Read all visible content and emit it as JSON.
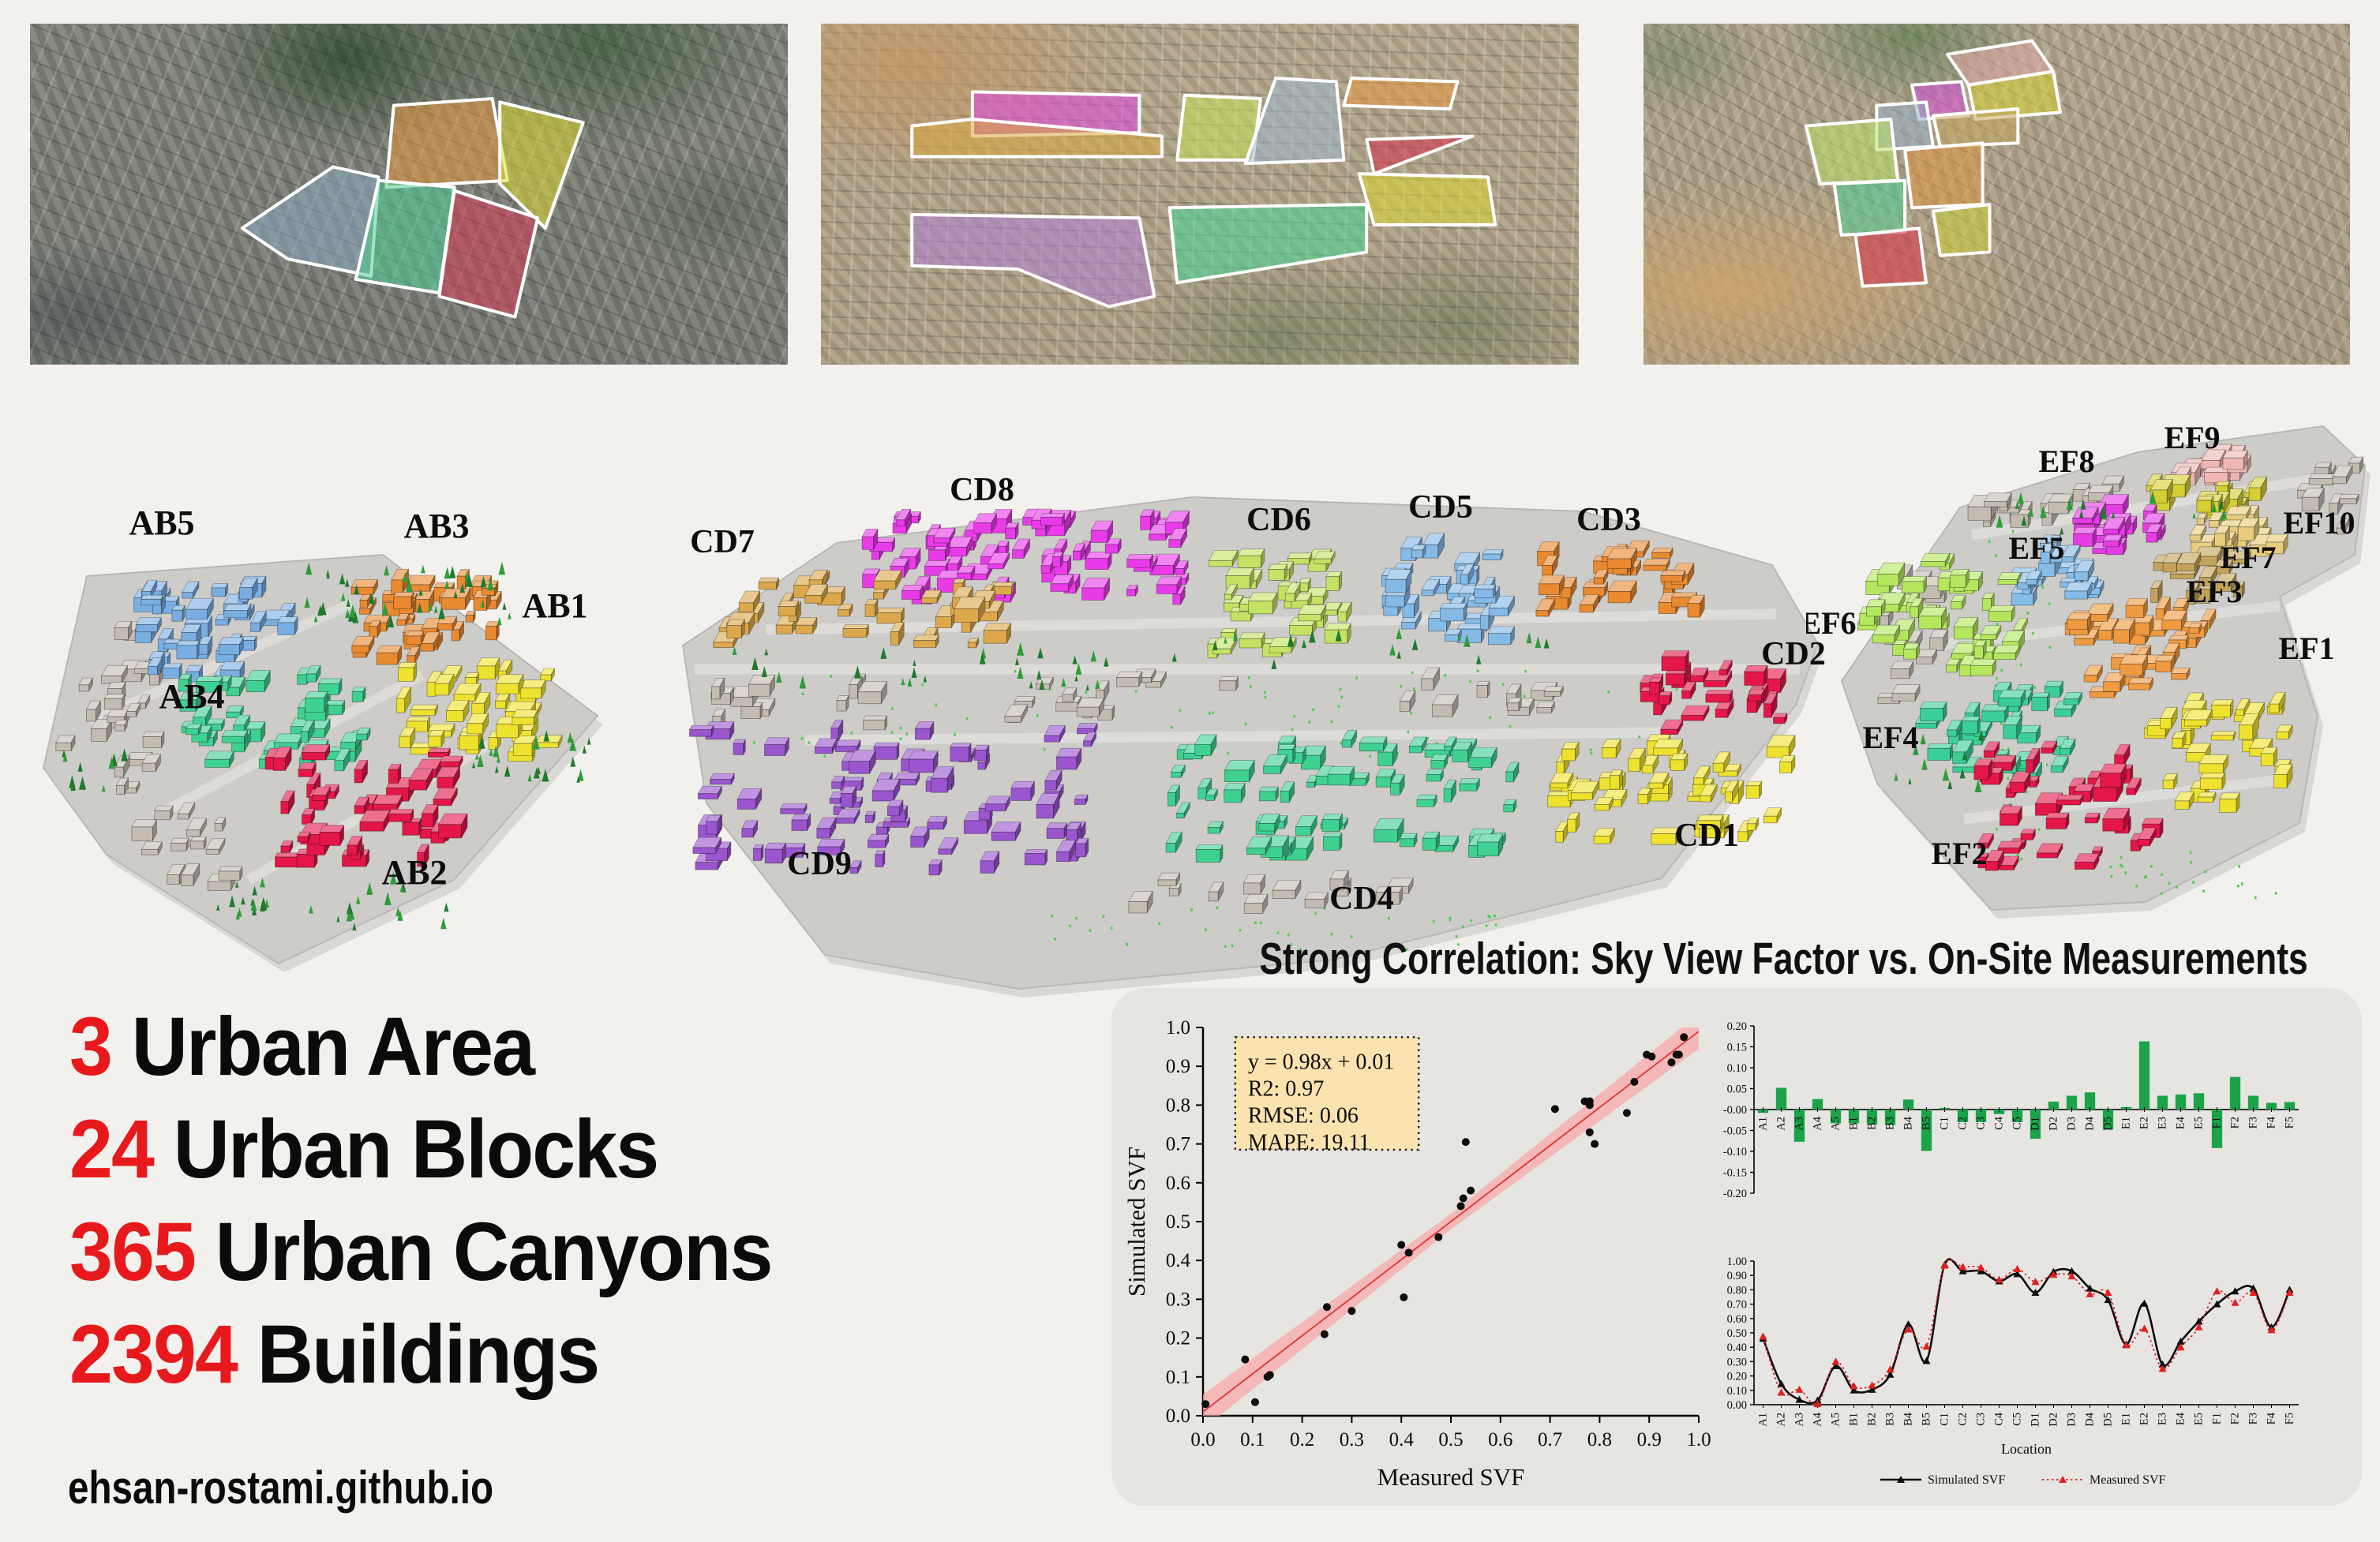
{
  "page": {
    "background": "#f2f1ee",
    "panel_background": "#e6e5e2",
    "accent_red": "#e8191c",
    "footer": "ehsan-rostami.github.io"
  },
  "stats": [
    {
      "value": "3",
      "label": "Urban Area"
    },
    {
      "value": "24",
      "label": "Urban Blocks"
    },
    {
      "value": "365",
      "label": "Urban Canyons"
    },
    {
      "value": "2394",
      "label": "Buildings"
    }
  ],
  "satellite_maps": [
    {
      "name": "urban-area-1",
      "blocks": [
        {
          "id": "o",
          "color": "#e8973f"
        },
        {
          "id": "y",
          "color": "#ded832"
        },
        {
          "id": "b",
          "color": "#8aa7c0"
        },
        {
          "id": "g",
          "color": "#4fd096"
        },
        {
          "id": "r",
          "color": "#d63a55"
        }
      ]
    },
    {
      "name": "urban-area-2",
      "blocks": [
        {
          "id": "m",
          "color": "#e147e1"
        },
        {
          "id": "gd",
          "color": "#d8a93f"
        },
        {
          "id": "yg",
          "color": "#c6e35a"
        },
        {
          "id": "bl",
          "color": "#9db8cf"
        },
        {
          "id": "or",
          "color": "#e8973f"
        },
        {
          "id": "re",
          "color": "#d62f4a"
        },
        {
          "id": "ye",
          "color": "#ded832"
        },
        {
          "id": "gr",
          "color": "#45d795"
        },
        {
          "id": "pu",
          "color": "#b07fd6"
        }
      ]
    },
    {
      "name": "urban-area-3",
      "blocks": [
        {
          "id": "pk",
          "color": "#e3aaa8"
        },
        {
          "id": "y1",
          "color": "#d9d437"
        },
        {
          "id": "mg",
          "color": "#d94fd9"
        },
        {
          "id": "bl",
          "color": "#93aec7"
        },
        {
          "id": "kh",
          "color": "#c4a55e"
        },
        {
          "id": "lg",
          "color": "#bce268"
        },
        {
          "id": "or",
          "color": "#e0953f"
        },
        {
          "id": "tl",
          "color": "#4fd096"
        },
        {
          "id": "y2",
          "color": "#cdd13a"
        },
        {
          "id": "re",
          "color": "#d62f4a"
        }
      ]
    }
  ],
  "models": [
    {
      "name": "model-AB",
      "blocks": [
        {
          "label": "AB5",
          "color": "#79aee3"
        },
        {
          "label": "AB3",
          "color": "#e98a31"
        },
        {
          "label": "AB1",
          "color": "#efe22f"
        },
        {
          "label": "AB4",
          "color": "#3ed192"
        },
        {
          "label": "AB2",
          "color": "#e4164a"
        }
      ]
    },
    {
      "name": "model-CD",
      "blocks": [
        {
          "label": "CD7",
          "color": "#dca84b"
        },
        {
          "label": "CD8",
          "color": "#e93be9"
        },
        {
          "label": "CD6",
          "color": "#c4e364"
        },
        {
          "label": "CD5",
          "color": "#85b9e6"
        },
        {
          "label": "CD3",
          "color": "#e98a31"
        },
        {
          "label": "CD2",
          "color": "#e4164a"
        },
        {
          "label": "CD1",
          "color": "#efe22f"
        },
        {
          "label": "CD9",
          "color": "#9a55cf"
        },
        {
          "label": "CD4",
          "color": "#3ed192"
        }
      ]
    },
    {
      "name": "model-EF",
      "blocks": [
        {
          "label": "EF9",
          "color": "#eeb7b4"
        },
        {
          "label": "EF8",
          "color": "#e53ce5"
        },
        {
          "label": "EF10",
          "color": "#e8cd7d"
        },
        {
          "label": "EF7",
          "color": "#c3a35b"
        },
        {
          "label": "EF5",
          "color": "#85bce8"
        },
        {
          "label": "EF3",
          "color": "#f09a40"
        },
        {
          "label": "EF6",
          "color": "#b5e75e"
        },
        {
          "label": "EF1",
          "color": "#efe22f"
        },
        {
          "label": "EF4",
          "color": "#3bcf97"
        },
        {
          "label": "EF2",
          "color": "#e4164a"
        }
      ]
    }
  ],
  "correlation": {
    "title": "Strong Correlation: Sky View Factor vs. On-Site Measurements"
  },
  "chart_data": [
    {
      "type": "scatter",
      "title": "",
      "xlabel": "Measured SVF",
      "ylabel": "Simulated SVF",
      "xlim": [
        0.0,
        1.0
      ],
      "ylim": [
        0.0,
        1.0
      ],
      "tick_step": 0.1,
      "annotation_lines": [
        "y = 0.98x + 0.01",
        "R2: 0.97",
        "RMSE: 0.06",
        "MAPE: 19.11"
      ],
      "fit": {
        "slope": 0.98,
        "intercept": 0.01
      },
      "point_color": "#0d0d0d",
      "line_color": "#e03434",
      "band_color": "#f7a8a8",
      "annotation_bg": "#fbe3b0",
      "points": [
        [
          0.475,
          0.46
        ],
        [
          0.085,
          0.145
        ],
        [
          0.105,
          0.035
        ],
        [
          0.005,
          0.03
        ],
        [
          0.3,
          0.27
        ],
        [
          0.13,
          0.1
        ],
        [
          0.135,
          0.105
        ],
        [
          0.245,
          0.21
        ],
        [
          0.525,
          0.56
        ],
        [
          0.405,
          0.305
        ],
        [
          0.97,
          0.975
        ],
        [
          0.96,
          0.93
        ],
        [
          0.955,
          0.93
        ],
        [
          0.87,
          0.86
        ],
        [
          0.945,
          0.91
        ],
        [
          0.855,
          0.78
        ],
        [
          0.905,
          0.925
        ],
        [
          0.895,
          0.93
        ],
        [
          0.77,
          0.81
        ],
        [
          0.78,
          0.73
        ],
        [
          0.415,
          0.42
        ],
        [
          0.53,
          0.705
        ],
        [
          0.25,
          0.28
        ],
        [
          0.4,
          0.44
        ],
        [
          0.54,
          0.58
        ],
        [
          0.79,
          0.7
        ],
        [
          0.71,
          0.79
        ],
        [
          0.78,
          0.81
        ],
        [
          0.52,
          0.54
        ],
        [
          0.78,
          0.8
        ]
      ]
    },
    {
      "type": "bar",
      "title": "",
      "categories": [
        "A1",
        "A2",
        "A3",
        "A4",
        "A5",
        "B1",
        "B2",
        "B3",
        "B4",
        "B5",
        "C1",
        "C2",
        "C3",
        "C4",
        "C5",
        "D1",
        "D2",
        "D3",
        "D4",
        "D5",
        "E1",
        "E2",
        "E3",
        "E4",
        "E5",
        "F1",
        "F2",
        "F3",
        "F4",
        "F5"
      ],
      "values": [
        -0.008,
        0.052,
        -0.077,
        0.025,
        -0.033,
        -0.033,
        -0.036,
        -0.037,
        0.024,
        -0.099,
        0.004,
        -0.03,
        -0.03,
        -0.011,
        -0.03,
        -0.07,
        0.019,
        0.033,
        0.041,
        -0.048,
        0.006,
        0.163,
        0.033,
        0.036,
        0.039,
        -0.092,
        0.078,
        0.033,
        0.016,
        0.018
      ],
      "ylim": [
        -0.2,
        0.2
      ],
      "tick_step": 0.05,
      "bar_color": "#1ca34a"
    },
    {
      "type": "line",
      "title": "",
      "xlabel": "Location",
      "categories": [
        "A1",
        "A2",
        "A3",
        "A4",
        "A5",
        "B1",
        "B2",
        "B3",
        "B4",
        "B5",
        "C1",
        "C2",
        "C3",
        "C4",
        "C5",
        "D1",
        "D2",
        "D3",
        "D4",
        "D5",
        "E1",
        "E2",
        "E3",
        "E4",
        "E5",
        "F1",
        "F2",
        "F3",
        "F4",
        "F5"
      ],
      "ylim": [
        0.0,
        1.0
      ],
      "tick_step": 0.1,
      "legend_position": "bottom",
      "series": [
        {
          "name": "Simulated SVF",
          "color": "#0d0d0d",
          "style": "solid",
          "values": [
            0.46,
            0.145,
            0.035,
            0.03,
            0.27,
            0.1,
            0.105,
            0.21,
            0.56,
            0.305,
            0.975,
            0.93,
            0.93,
            0.86,
            0.91,
            0.78,
            0.925,
            0.93,
            0.81,
            0.73,
            0.42,
            0.705,
            0.28,
            0.44,
            0.58,
            0.7,
            0.79,
            0.81,
            0.54,
            0.8
          ]
        },
        {
          "name": "Measured SVF",
          "color": "#e01f1f",
          "style": "dotted",
          "values": [
            0.475,
            0.085,
            0.105,
            0.005,
            0.3,
            0.13,
            0.135,
            0.245,
            0.525,
            0.405,
            0.97,
            0.96,
            0.955,
            0.87,
            0.945,
            0.855,
            0.905,
            0.895,
            0.77,
            0.78,
            0.415,
            0.53,
            0.25,
            0.4,
            0.54,
            0.79,
            0.71,
            0.78,
            0.52,
            0.78
          ]
        }
      ]
    }
  ]
}
